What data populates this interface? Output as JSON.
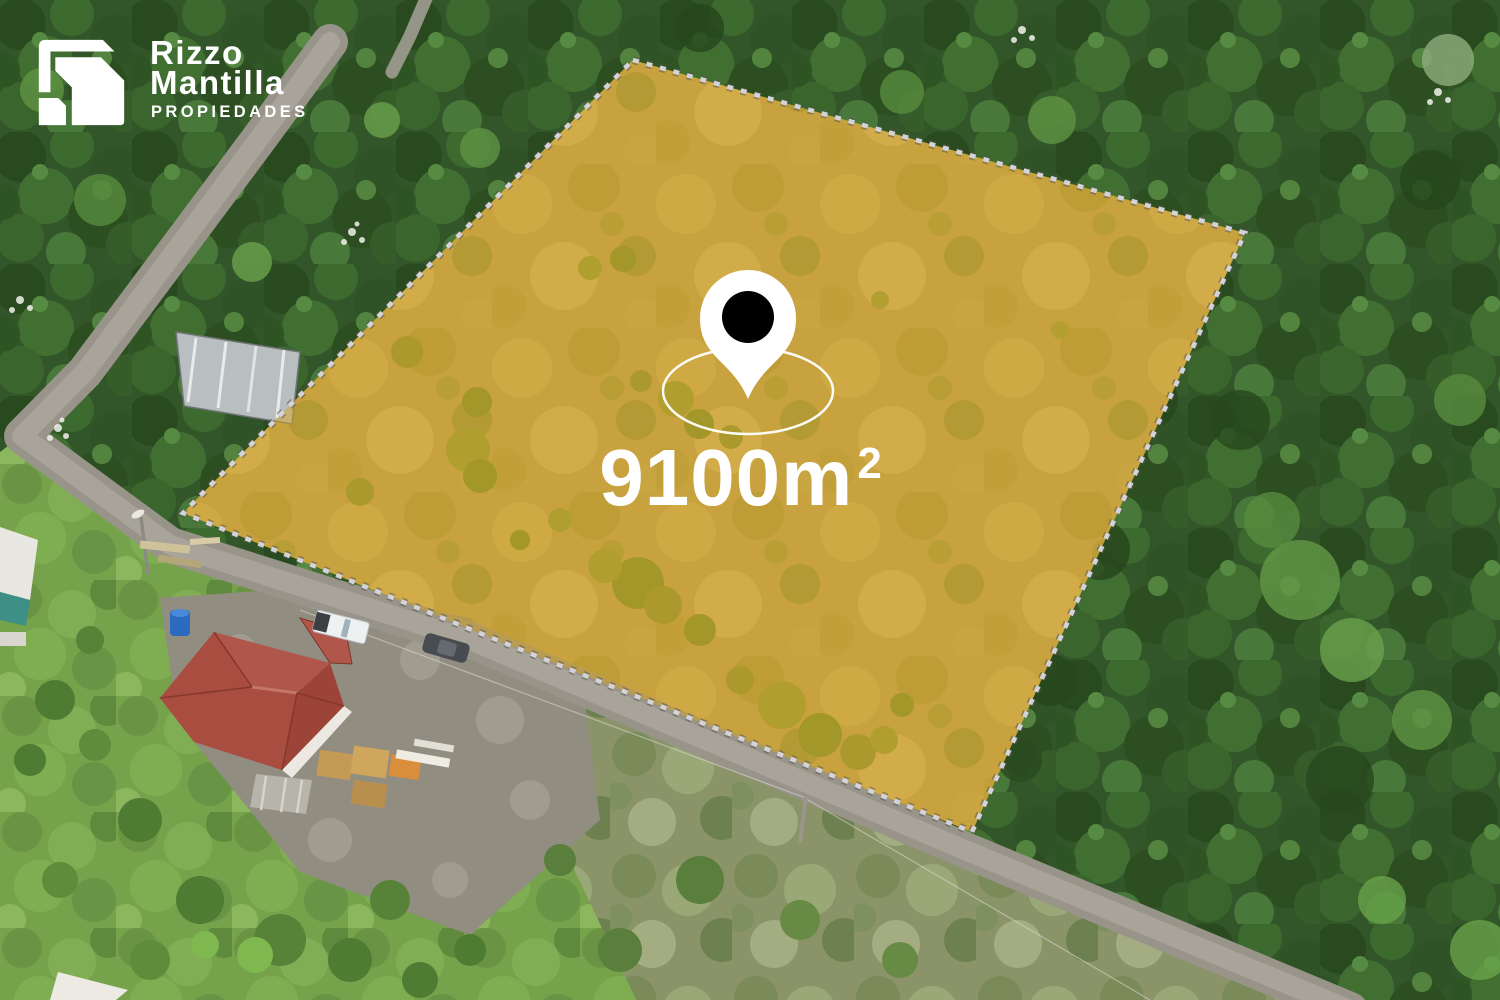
{
  "branding": {
    "line1": "Rizzo",
    "line2": "Mantilla",
    "tagline": "PROPIEDADES",
    "logo_icon": "nested-corner-mark",
    "text_color": "#FFFFFF"
  },
  "lot": {
    "area_value": "9100m",
    "area_exponent": "2",
    "highlight_fill": "#D9A41E",
    "boundary_dash_color": "#D3D3D9",
    "marker": {
      "pin_fill": "#FFFFFF",
      "pin_dot_fill": "#000000",
      "ring_color": "#FFFFFF"
    }
  }
}
